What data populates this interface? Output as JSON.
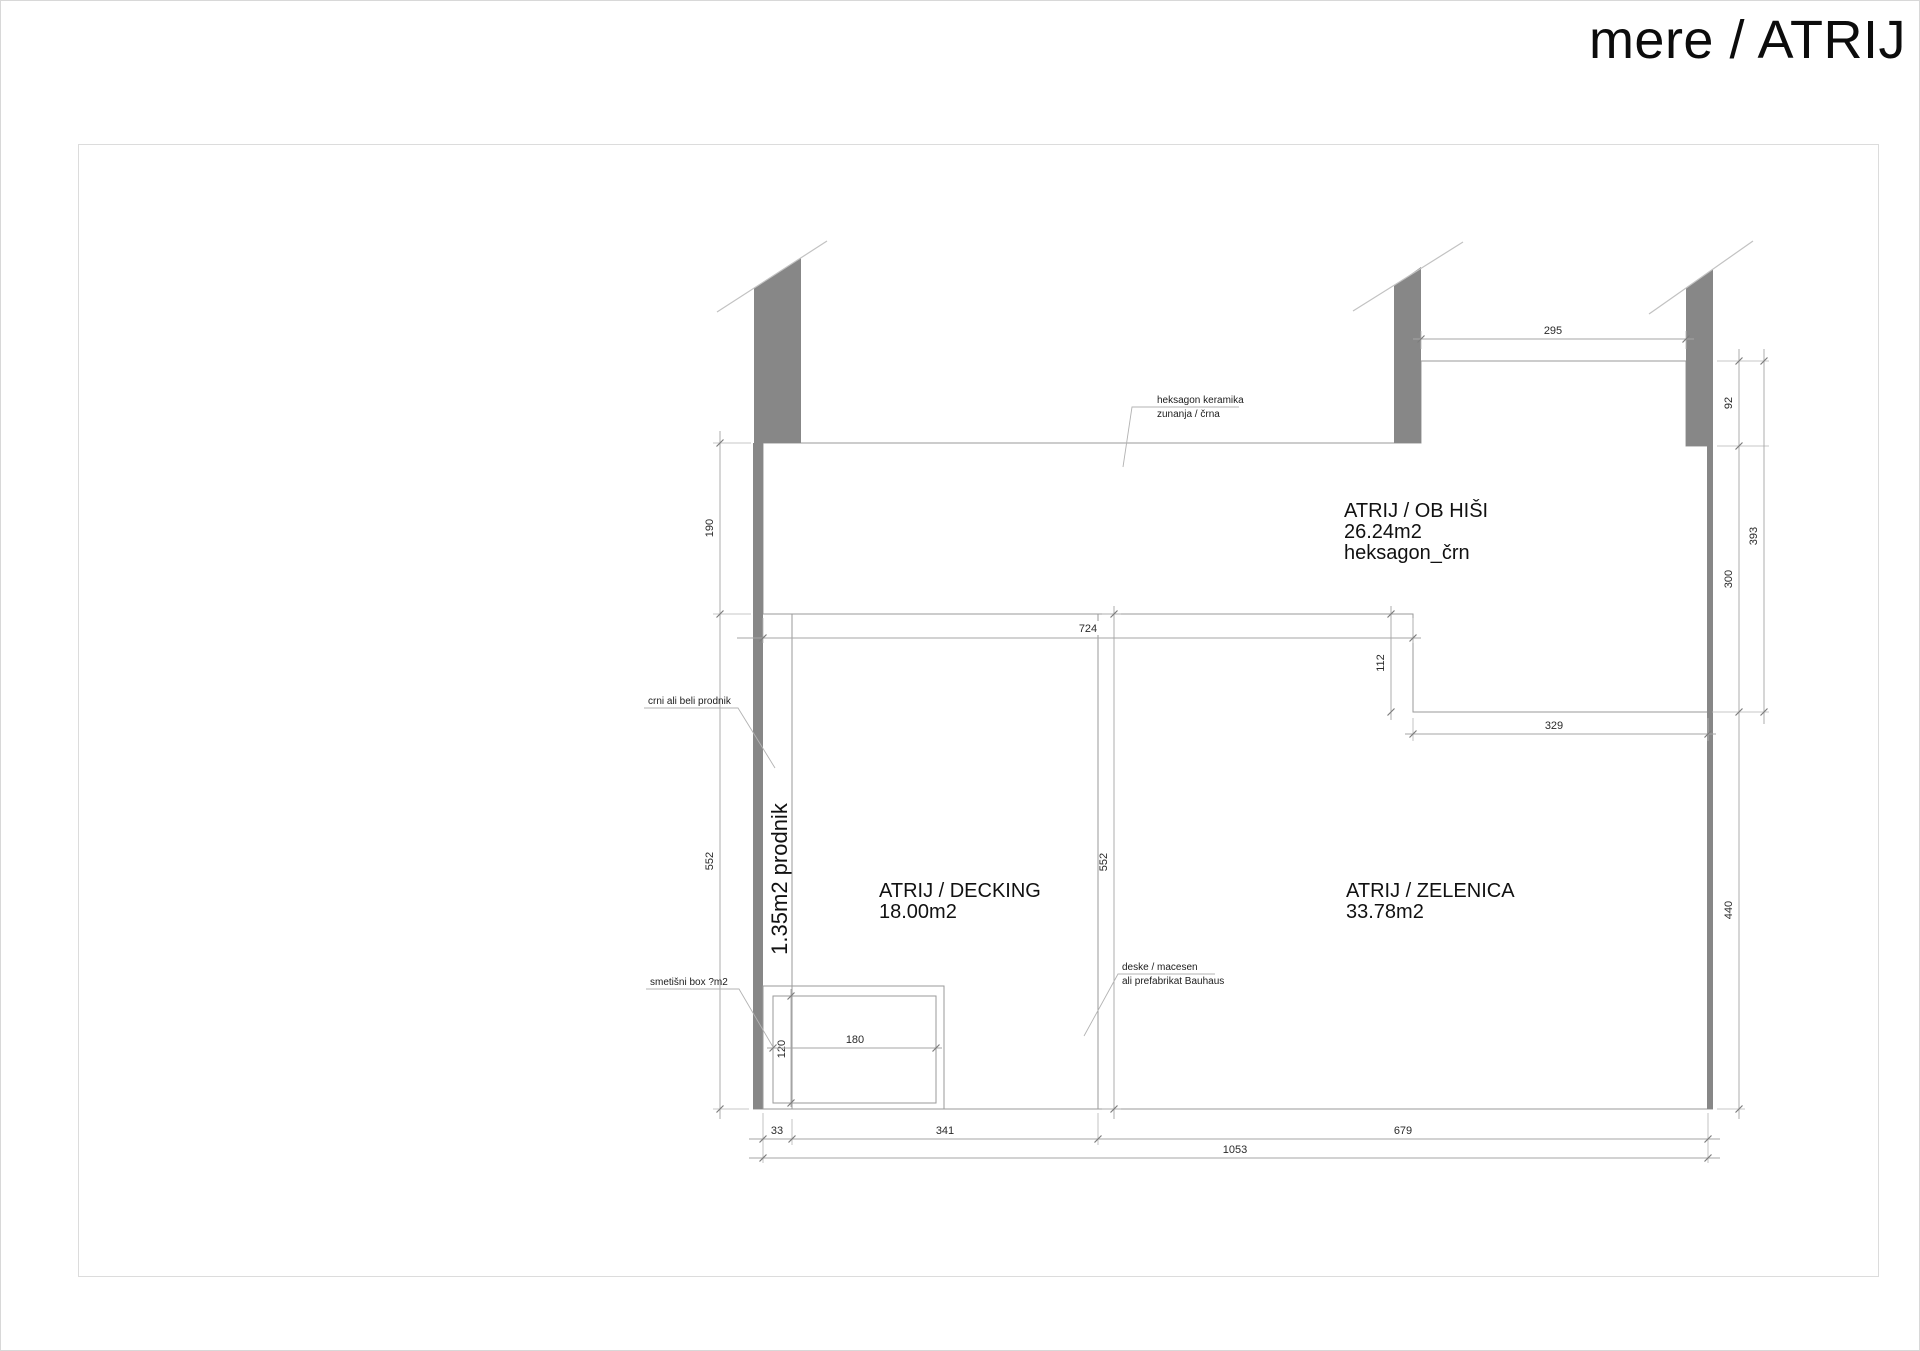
{
  "page": {
    "title": "mere / ATRIJ"
  },
  "rooms": {
    "ob_hisi": {
      "name": "ATRIJ / OB HIŠI",
      "area": "26.24m2",
      "material": "heksagon_črn"
    },
    "decking": {
      "name": "ATRIJ / DECKING",
      "area": "18.00m2"
    },
    "zelenica": {
      "name": "ATRIJ / ZELENICA",
      "area": "33.78m2"
    },
    "prodnik_strip": {
      "label": "1.35m2 prodnik"
    }
  },
  "annotations": {
    "heksagon_keramika": {
      "line1": "heksagon keramika",
      "line2": "zunanja / črna"
    },
    "prodnik_note": {
      "text": "crni ali beli prodnik"
    },
    "smetisni_box": {
      "text": "smetišni box ?m2"
    },
    "deske": {
      "line1": "deske / macesen",
      "line2": "ali prefabrikat Bauhaus"
    }
  },
  "dimensions": {
    "top_opening": "295",
    "right_92": "92",
    "right_393": "393",
    "right_300": "300",
    "right_440": "440",
    "left_190": "190",
    "left_552": "552",
    "mid_552": "552",
    "mid_724": "724",
    "notch_112": "112",
    "notch_329": "329",
    "box_120": "120",
    "box_180": "180",
    "bottom_33": "33",
    "bottom_341": "341",
    "bottom_679": "679",
    "bottom_1053": "1053"
  },
  "colors": {
    "wall": "#878787",
    "edge": "#9a9a9a",
    "hex_line": "#cccccc",
    "plank_line": "#b5b5b5",
    "text": "#1c1c1c"
  }
}
